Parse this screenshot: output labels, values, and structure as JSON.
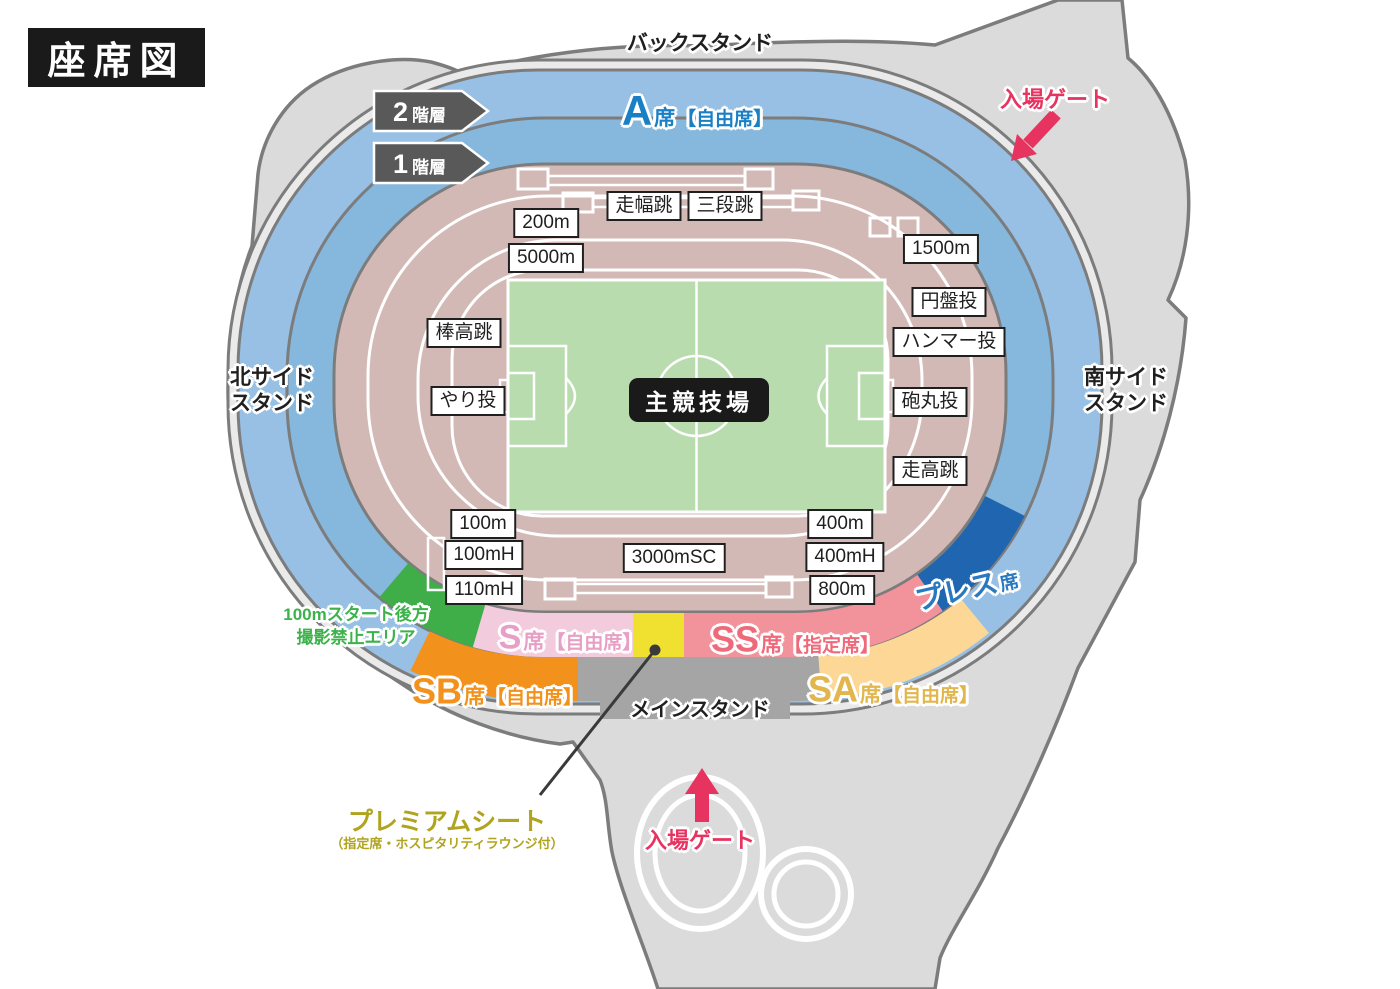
{
  "title": "座席図",
  "stands": {
    "back": "バックスタンド",
    "north_line1": "北サイド",
    "north_line2": "スタンド",
    "south_line1": "南サイド",
    "south_line2": "スタンド",
    "main": "メインスタンド",
    "field": "主競技場"
  },
  "floors": {
    "f2_num": "2",
    "f2_suffix": "階層",
    "f1_num": "1",
    "f1_suffix": "階層"
  },
  "gates": {
    "top": "入場ゲート",
    "bottom": "入場ゲート"
  },
  "seats": {
    "a": {
      "code": "A",
      "seat": "席",
      "type": "【自由席】"
    },
    "s": {
      "code": "S",
      "seat": "席",
      "type": "【自由席】"
    },
    "ss": {
      "code": "SS",
      "seat": "席",
      "type": "【指定席】"
    },
    "sb": {
      "code": "SB",
      "seat": "席",
      "type": "【自由席】"
    },
    "sa": {
      "code": "SA",
      "seat": "席",
      "type": "【自由席】"
    },
    "press": {
      "code": "プレス",
      "seat": "席"
    },
    "premium": {
      "title": "プレミアムシート",
      "subtitle": "（指定席・ホスピタリティラウンジ付）"
    },
    "no_photo": {
      "line1": "100mスタート後方",
      "line2": "撮影禁止エリア"
    }
  },
  "events": [
    {
      "label": "200m",
      "x": 546,
      "y": 223
    },
    {
      "label": "5000m",
      "x": 546,
      "y": 258
    },
    {
      "label": "走幅跳",
      "x": 644,
      "y": 206
    },
    {
      "label": "三段跳",
      "x": 725,
      "y": 206
    },
    {
      "label": "1500m",
      "x": 941,
      "y": 249
    },
    {
      "label": "円盤投",
      "x": 949,
      "y": 302
    },
    {
      "label": "ハンマー投",
      "x": 949,
      "y": 342
    },
    {
      "label": "棒高跳",
      "x": 464,
      "y": 333
    },
    {
      "label": "やり投",
      "x": 468,
      "y": 401
    },
    {
      "label": "砲丸投",
      "x": 930,
      "y": 402
    },
    {
      "label": "走高跳",
      "x": 930,
      "y": 471
    },
    {
      "label": "100m",
      "x": 483,
      "y": 524
    },
    {
      "label": "100mH",
      "x": 484,
      "y": 555
    },
    {
      "label": "110mH",
      "x": 484,
      "y": 590
    },
    {
      "label": "3000mSC",
      "x": 674,
      "y": 558
    },
    {
      "label": "400m",
      "x": 840,
      "y": 524
    },
    {
      "label": "400mH",
      "x": 845,
      "y": 557
    },
    {
      "label": "800m",
      "x": 842,
      "y": 590
    }
  ],
  "colors": {
    "concourse": "#dbdbdb",
    "concourse_light": "#eaeaea",
    "outline": "#7c7c7c",
    "ring_outer": "#97c0e4",
    "ring_inner": "#86b7dd",
    "track": "#d3b9b6",
    "field": "#b9dcaf",
    "white_line": "#ffffff",
    "black_box": "#1a1a1a",
    "floor_tag": "#595959",
    "seat_a_text": "#1a80c5",
    "seat_s": "#f2cbdd",
    "seat_s_text": "#e89fc5",
    "seat_ss": "#f2939c",
    "seat_ss_text": "#ee6a7a",
    "seat_sb": "#f2921d",
    "seat_sb_text": "#f2921d",
    "seat_sa": "#fcd795",
    "seat_sa_text": "#e2b64d",
    "press": "#1f65af",
    "press_text": "#2a79bf",
    "premium_seat": "#f0e030",
    "premium_text": "#b0a41e",
    "no_photo": "#3fae49",
    "no_photo_text": "#3cb24a",
    "main_stand": "#a5a5a5",
    "gate": "#e73360",
    "leader": "#3a3a3a"
  }
}
